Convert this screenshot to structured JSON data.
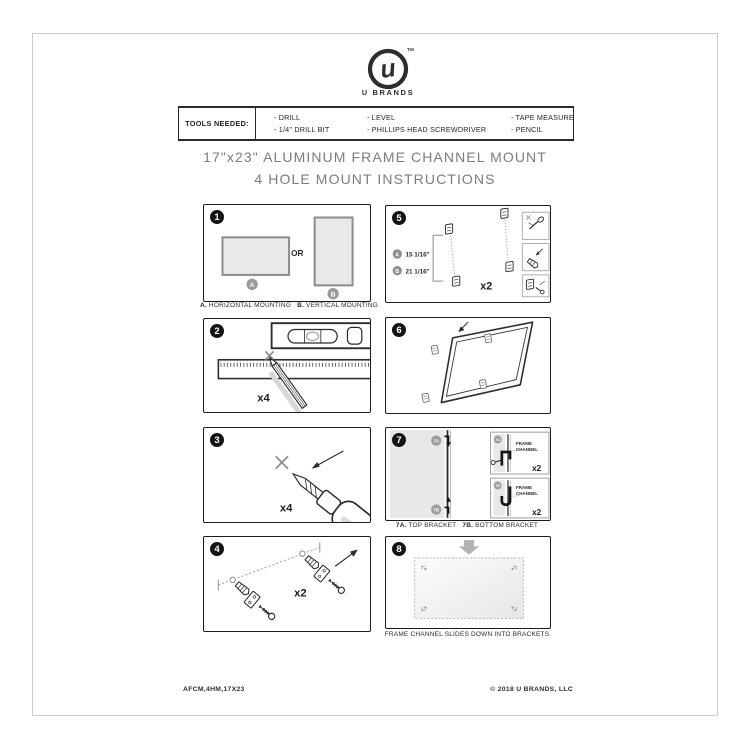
{
  "logo": {
    "monogram": "u",
    "tm": "TM",
    "brand": "U BRANDS"
  },
  "tools": {
    "label": "TOOLS NEEDED:",
    "col1": [
      "- DRILL",
      "- 1/4\" DRILL BIT"
    ],
    "col2": [
      "- LEVEL",
      "- PHILLIPS HEAD SCREWDRIVER"
    ],
    "col3": [
      "- TAPE MEASURE",
      "- PENCIL"
    ]
  },
  "title": {
    "line1": "17\"x23\" ALUMINUM FRAME CHANNEL MOUNT",
    "line2": "4 HOLE MOUNT INSTRUCTIONS"
  },
  "steps": {
    "step1": {
      "num": "1",
      "or_text": "OR",
      "marker_a": "A",
      "marker_b": "B",
      "cap_a_prefix": "A.",
      "cap_a_text": "HORIZONTAL MOUNTING",
      "cap_b_prefix": "B.",
      "cap_b_text": "VERTICAL MOUNTING"
    },
    "step2": {
      "num": "2",
      "count": "x4"
    },
    "step3": {
      "num": "3",
      "count": "x4"
    },
    "step4": {
      "num": "4",
      "count": "x2"
    },
    "step5": {
      "num": "5",
      "marker_a": "A",
      "dim_a": "15 1/16\"",
      "marker_b": "B",
      "dim_b": "21 1/16\"",
      "count": "x2"
    },
    "step6": {
      "num": "6"
    },
    "step7": {
      "num": "7",
      "marker_top": "7A",
      "marker_bottom": "7B",
      "frame_channel_label": "FRAME CHANNEL",
      "count_top": "x2",
      "count_bottom": "x2",
      "cap_top_prefix": "7A.",
      "cap_top_text": "TOP BRACKET",
      "cap_bottom_prefix": "7B.",
      "cap_bottom_text": "BOTTOM BRACKET"
    },
    "step8": {
      "num": "8",
      "caption": "FRAME CHANNEL SLIDES DOWN INTO BRACKETS"
    }
  },
  "footer": {
    "left": "AFCM,4HM,17X23",
    "right": "© 2018 U BRANDS, LLC"
  },
  "colors": {
    "black": "#1c1c1c",
    "light_gray": "#e9e9e9",
    "mid_gray": "#9b9b9b",
    "title_gray": "#7c7c7c"
  }
}
